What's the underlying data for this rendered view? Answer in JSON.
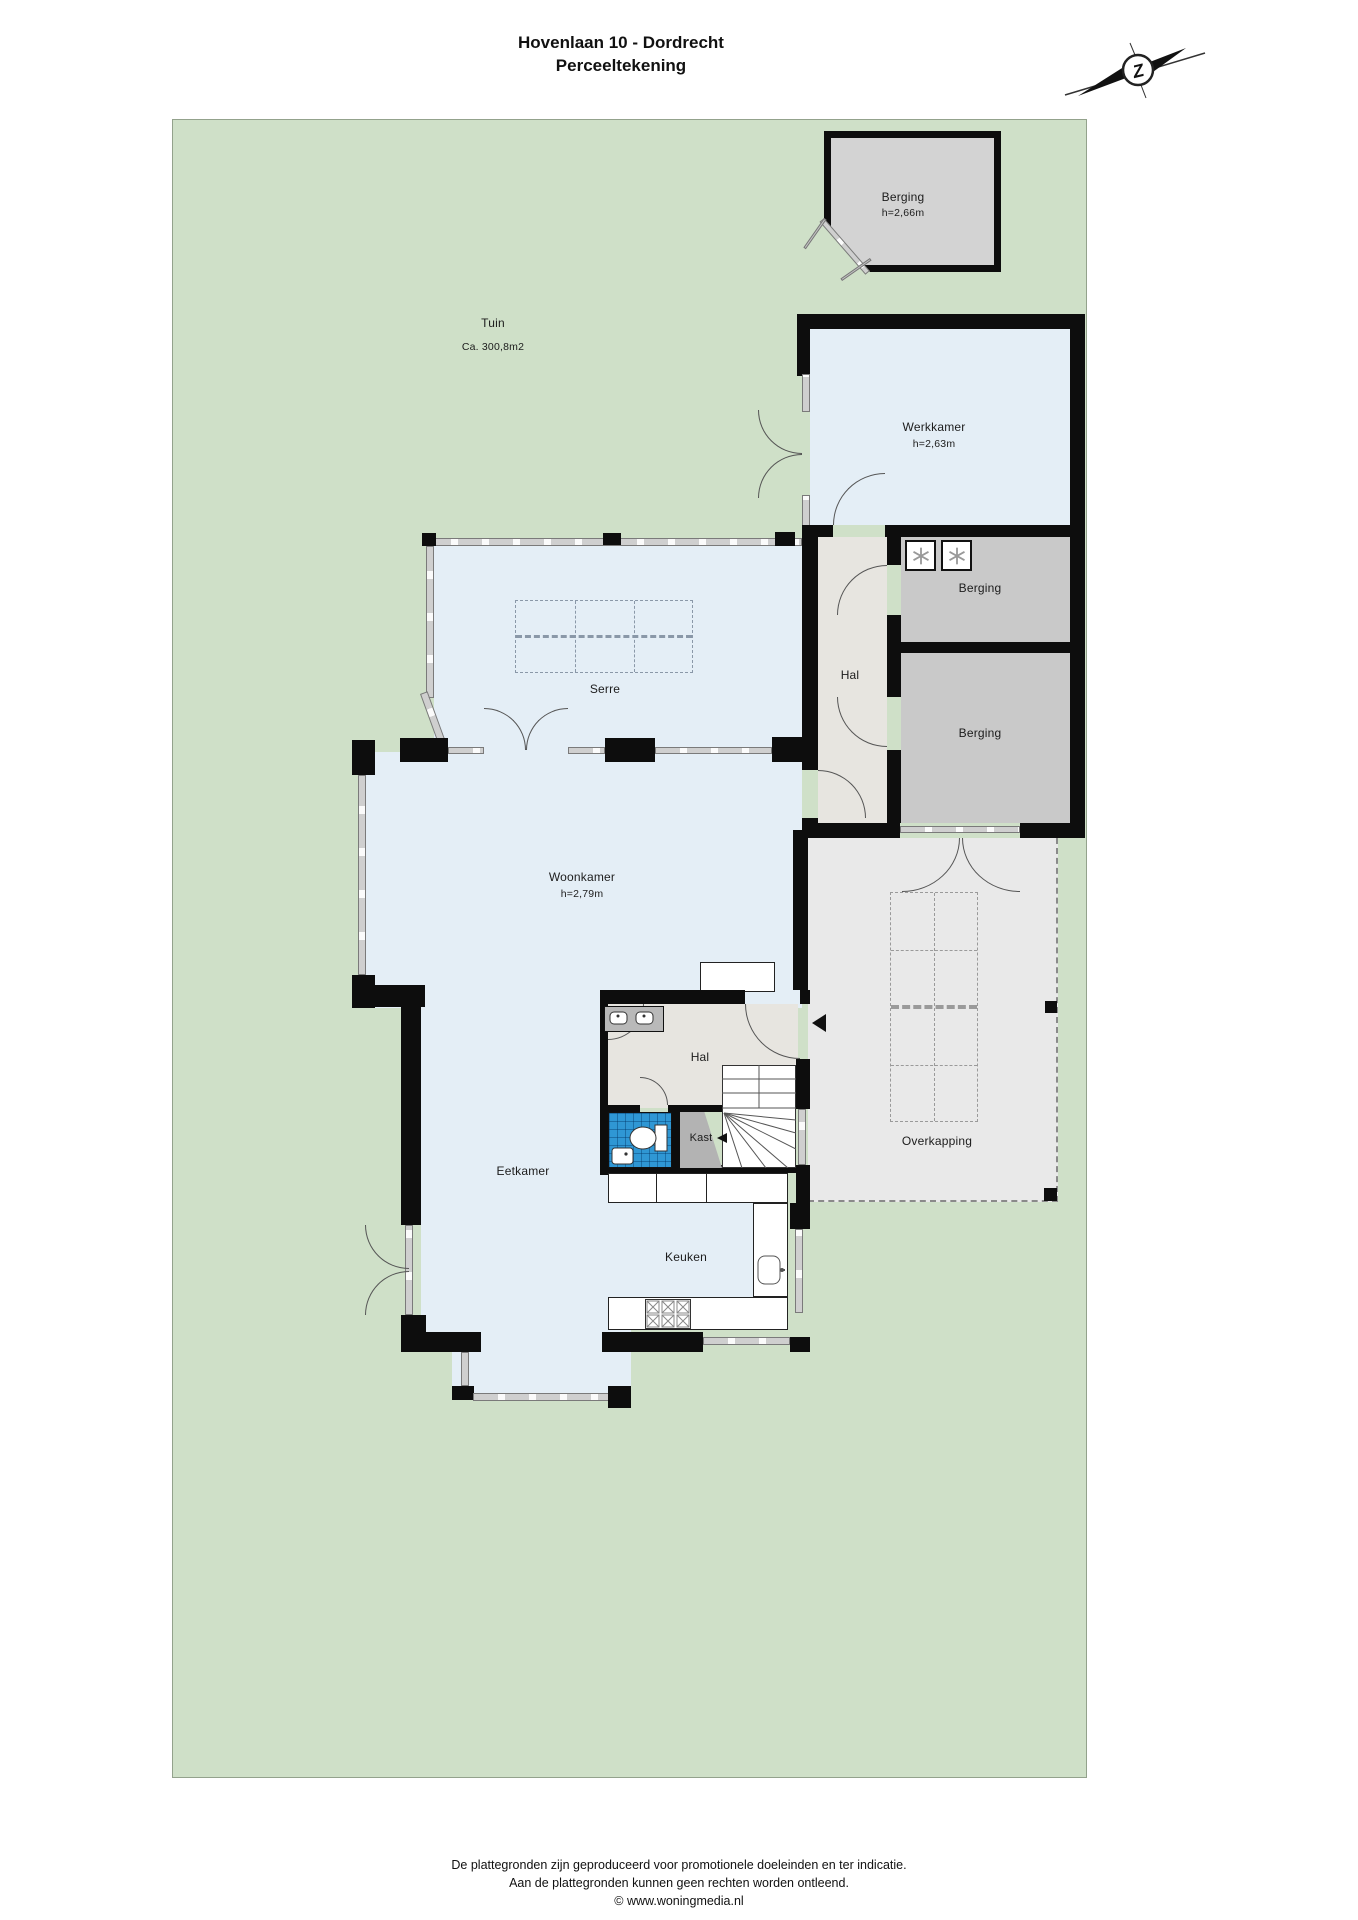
{
  "title": {
    "line1": "Hovenlaan 10 - Dordrecht",
    "line2": "Perceeltekening"
  },
  "compass": {
    "letter": "Z"
  },
  "garden": {
    "label": "Tuin",
    "area": "Ca. 300,8m2"
  },
  "rooms": {
    "shed": {
      "label": "Berging",
      "height": "h=2,66m"
    },
    "werkkamer": {
      "label": "Werkkamer",
      "height": "h=2,63m"
    },
    "berging_1": {
      "label": "Berging"
    },
    "berging_2": {
      "label": "Berging"
    },
    "hal_upper": {
      "label": "Hal"
    },
    "serre": {
      "label": "Serre"
    },
    "woonkamer": {
      "label": "Woonkamer",
      "height": "h=2,79m"
    },
    "hal_lower": {
      "label": "Hal"
    },
    "kast": {
      "label": "Kast"
    },
    "eetkamer": {
      "label": "Eetkamer"
    },
    "keuken": {
      "label": "Keuken"
    },
    "overkapping": {
      "label": "Overkapping"
    }
  },
  "footer": {
    "line1": "De plattegronden zijn geproduceerd voor promotionele doeleinden en ter indicatie.",
    "line2": "Aan de plattegronden kunnen geen rechten worden ontleend.",
    "line3": "© www.woningmedia.nl"
  },
  "colors": {
    "garden": "#cfe0c8",
    "garden-border": "#93a28c",
    "room": "#e4eef6",
    "hal": "#e7e5e0",
    "berging": "#c9c9c9",
    "overkapping": "#e9e9e9",
    "shed": "#d3d3d3",
    "wall": "#0d0d0d",
    "window": "#d8d8d8",
    "toilet": "#2f97d4",
    "kast": "#b3b3b3"
  }
}
